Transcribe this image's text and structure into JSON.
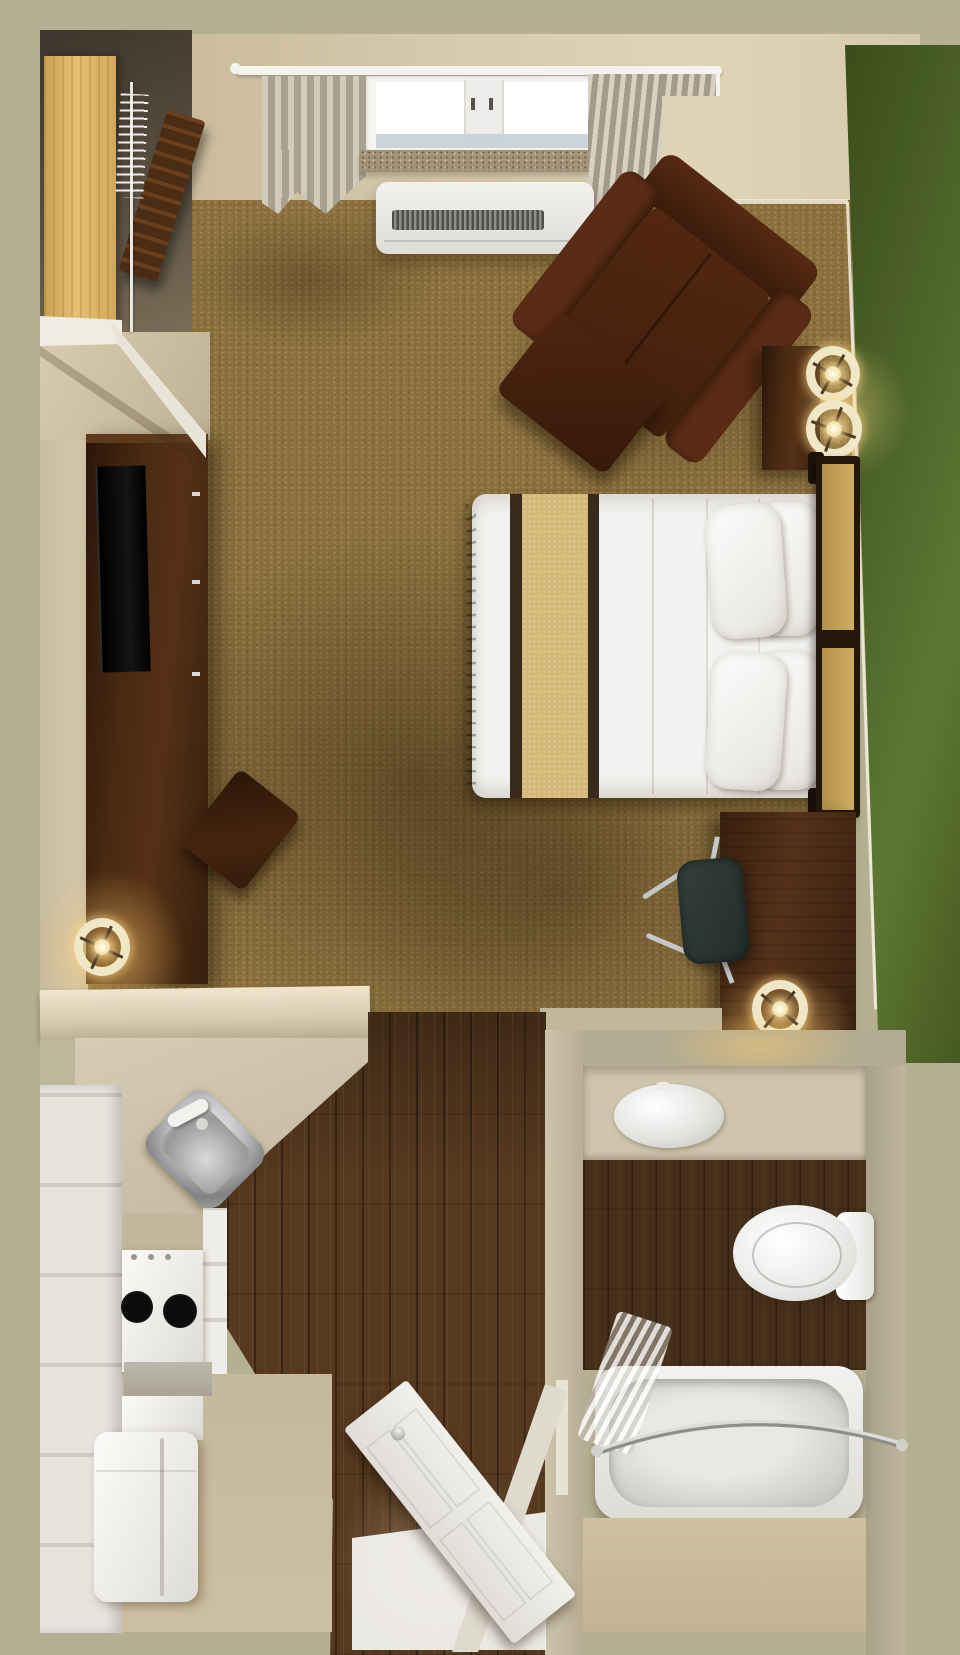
{
  "scene": {
    "type": "3d-floor-plan-top-view",
    "description": "Top-down 3D rendering of a studio apartment / extended-stay hotel room with bedroom, kitchenette, entry hall and bathroom",
    "visible_text": "",
    "rooms": [
      {
        "name": "bedroom",
        "floor": "tan carpet",
        "furniture": [
          "closet with hanging rod and hangers",
          "luggage rack",
          "wall shelf",
          "media credenza with flat-screen tv",
          "side chair",
          "floor lamp",
          "window with curtains",
          "ptac air-conditioner unit",
          "leather armchair",
          "ottoman",
          "side table with two table lamps",
          "queen bed with striped duvet and four pillows",
          "headboard",
          "work desk",
          "office chair",
          "desk lamp"
        ]
      },
      {
        "name": "kitchenette",
        "floor": "beige vinyl + dark wood",
        "furniture": [
          "corner counter",
          "stainless sink with faucet",
          "tall white cabinets",
          "two-burner stove",
          "dishwasher panel",
          "counter strip",
          "refrigerator"
        ]
      },
      {
        "name": "entry-hall",
        "floor": "dark wood planks",
        "furniture": [
          "entry door (open)",
          "door threshold"
        ]
      },
      {
        "name": "bathroom",
        "floor": "dark wood + beige",
        "furniture": [
          "vanity counter with oval sink",
          "toilet with tank",
          "bathtub",
          "curved shower rod",
          "shower curtain"
        ]
      }
    ],
    "accent_features": [
      "green accent wall on east side",
      "khaki exterior wall border"
    ]
  },
  "palette": {
    "khaki": "#b6b093",
    "wall": "#d2c5a8",
    "wallDark": "#b9a98c",
    "carpet": "#8d7240",
    "woodFloor": "#56391f",
    "bathWood": "#47301a",
    "furnWood": "#46290f",
    "espresso": "#241609",
    "headboardTan": "#c4a257",
    "bedWhite": "#f3f2f0",
    "bedTan": "#d5b778",
    "bedStripe": "#3a2a1b",
    "chairBrown": "#4a230f",
    "chairArm": "#5a2c15",
    "counter": "#cabfa8",
    "counterLit": "#eadferr0",
    "counterLight": "#e9dfc6",
    "steel": "#b9babb",
    "officeChair": "#2c3835",
    "chrome": "#c3c7c6",
    "lampShade": "#f0e7c6",
    "glowWarm": "#ffd98c",
    "porcelain": "#f0f0ee",
    "bathWall": "#c6bda4",
    "vanity": "#cfc5ae",
    "glassBlue": "#c6d0d8",
    "sillStone": "#a3937a",
    "greenWall": "#4d642a",
    "doorWhite": "#efede8"
  }
}
